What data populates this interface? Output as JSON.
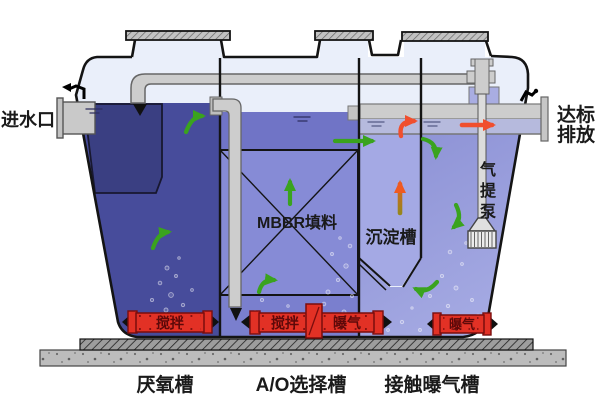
{
  "diagram": {
    "labels": {
      "inlet": "进水口",
      "discharge": [
        "达标",
        "排放"
      ],
      "mbbr_media": "MBBR填料",
      "settling_tank": "沉淀槽",
      "airlift_pump_chars": [
        "气",
        "提",
        "泵"
      ],
      "anaerobic_tank": "厌氧槽",
      "ao_selector_tank": "A/O选择槽",
      "contact_aeration_tank": "接触曝气槽"
    },
    "devices": {
      "left_stirrer": "搅拌",
      "mid_stirrer": "搅拌",
      "mid_aerator": "曝气",
      "right_aerator": "曝气"
    },
    "colors": {
      "anaerobic_water": "#474c9b",
      "anaerobic_baffle": "#3a3f82",
      "ao_water": "#7a7fce",
      "ao_surface_strip": "#7074c6",
      "mbbr_box": "#868bd6",
      "settling_water": "#a4a9e4",
      "aeration_water": "#8e93d6",
      "aeration_water_light": "#a7ace4",
      "trough_water": "#b6badd",
      "headspace": "#eaeffa",
      "pipe_gray": "#cdcdcd",
      "pump_block": "#a9ade2",
      "device_red": "#e23125",
      "device_red_dark": "#7a0d0d",
      "device_text": "#5d0909",
      "arrow_green": "#3aa31e",
      "arrow_red": "#f04f2e",
      "arrow_orange_head": "#ef5a22",
      "arrow_orange_tail": "#97861c",
      "concrete": "#bcbcbc",
      "outline": "#141414",
      "label_text": "#1a1a1a"
    }
  }
}
